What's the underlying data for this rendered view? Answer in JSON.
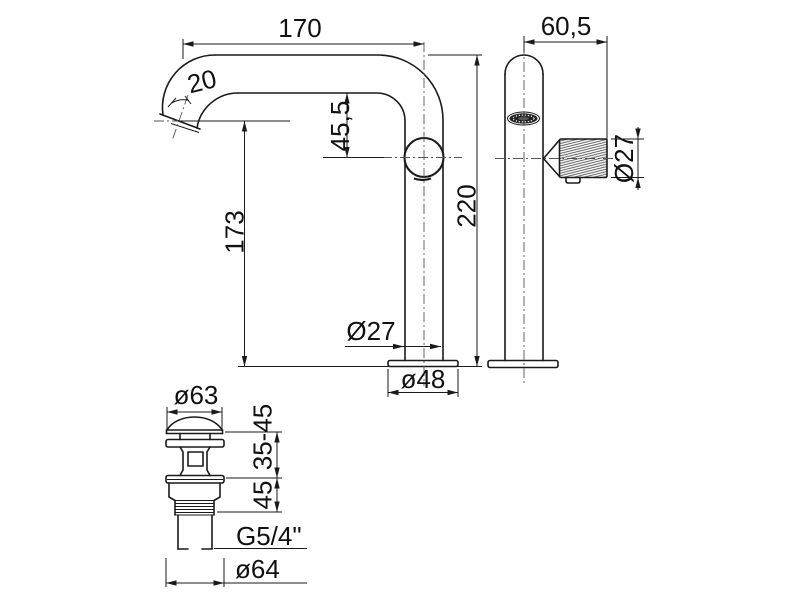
{
  "colors": {
    "line": "#1a1a1a",
    "centerline": "#555555",
    "text": "#111111",
    "background": "#ffffff"
  },
  "side": {
    "name": "faucet-side-view",
    "dims": {
      "spout_reach": "170",
      "spout_tip_angle": "20",
      "spout_to_handle": "45,5",
      "outlet_height": "173",
      "total_height": "220",
      "column_diameter": "Ø27",
      "base_diameter": "ø48"
    }
  },
  "front": {
    "name": "faucet-front-view",
    "dims": {
      "handle_offset": "60,5",
      "handle_diameter": "Ø27"
    }
  },
  "drain": {
    "name": "pop-up-waste-view",
    "dims": {
      "cap_diameter": "ø63",
      "clamp_range": "35-45",
      "thread_length": "45",
      "thread_size": "G5/4\"",
      "outlet_diameter": "ø64"
    }
  }
}
